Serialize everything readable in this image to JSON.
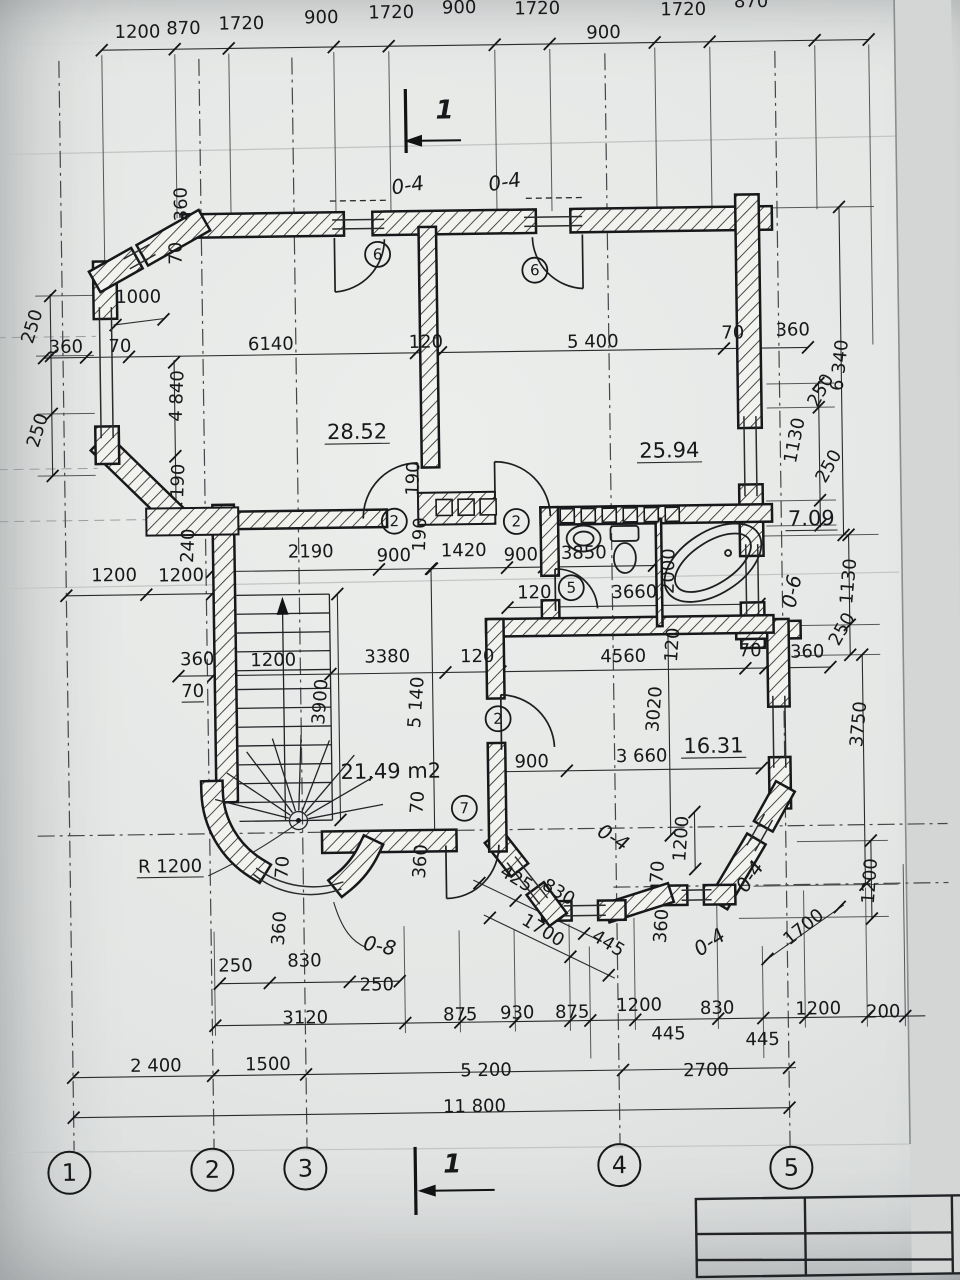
{
  "sheet": {
    "type": "architectural-floor-plan",
    "scan_style": "photographed blueprint"
  },
  "colors": {
    "ink": "#1a1b1d",
    "paper": "#e9eae7",
    "shadow": "#c0c3c5"
  },
  "annotations": {
    "section_label": "1",
    "dims": [
      {
        "t": "1200",
        "x": 146,
        "y": 33
      },
      {
        "t": "870",
        "x": 192,
        "y": 30
      },
      {
        "t": "1720",
        "x": 250,
        "y": 26
      },
      {
        "t": "900",
        "x": 330,
        "y": 21
      },
      {
        "t": "1720",
        "x": 400,
        "y": 17
      },
      {
        "t": "900",
        "x": 468,
        "y": 13
      },
      {
        "t": "1720",
        "x": 546,
        "y": 15
      },
      {
        "t": "900",
        "x": 612,
        "y": 40
      },
      {
        "t": "1720",
        "x": 692,
        "y": 18
      },
      {
        "t": "870",
        "x": 760,
        "y": 11
      },
      {
        "t": "360",
        "x": 193,
        "y": 200,
        "r": -90
      },
      {
        "t": "70",
        "x": 187,
        "y": 249,
        "r": -90
      },
      {
        "t": "1000",
        "x": 143,
        "y": 298
      },
      {
        "t": "250",
        "x": 42,
        "y": 322,
        "r": -72
      },
      {
        "t": "250",
        "x": 46,
        "y": 426,
        "r": -72
      },
      {
        "t": "360",
        "x": 70,
        "y": 347
      },
      {
        "t": "70",
        "x": 124,
        "y": 347
      },
      {
        "t": "6140",
        "x": 275,
        "y": 347
      },
      {
        "t": "120",
        "x": 430,
        "y": 347
      },
      {
        "t": "5 400",
        "x": 597,
        "y": 349
      },
      {
        "t": "70",
        "x": 737,
        "y": 342
      },
      {
        "t": "360",
        "x": 797,
        "y": 340
      },
      {
        "t": "4 840",
        "x": 186,
        "y": 392,
        "r": -87
      },
      {
        "t": "190",
        "x": 186,
        "y": 477,
        "r": -87
      },
      {
        "t": "6 340",
        "x": 849,
        "y": 371,
        "r": -83
      },
      {
        "t": "250",
        "x": 829,
        "y": 398,
        "r": -60
      },
      {
        "t": "1130",
        "x": 803,
        "y": 446,
        "r": -78
      },
      {
        "t": "250",
        "x": 836,
        "y": 474,
        "r": -60
      },
      {
        "t": "240",
        "x": 195,
        "y": 542,
        "r": -87
      },
      {
        "t": "2190",
        "x": 312,
        "y": 555
      },
      {
        "t": "900",
        "x": 395,
        "y": 560
      },
      {
        "t": "1420",
        "x": 465,
        "y": 556
      },
      {
        "t": "900",
        "x": 522,
        "y": 561
      },
      {
        "t": "3850",
        "x": 585,
        "y": 560
      },
      {
        "t": "190",
        "x": 421,
        "y": 478,
        "r": -87
      },
      {
        "t": "190",
        "x": 427,
        "y": 534,
        "r": -87
      },
      {
        "t": "1200",
        "x": 115,
        "y": 576
      },
      {
        "t": "1200",
        "x": 182,
        "y": 577
      },
      {
        "t": "120",
        "x": 535,
        "y": 599
      },
      {
        "t": "3660",
        "x": 635,
        "y": 600
      },
      {
        "t": "2000",
        "x": 675,
        "y": 574,
        "r": -88
      },
      {
        "t": "1130",
        "x": 855,
        "y": 587,
        "r": -84
      },
      {
        "t": "250",
        "x": 847,
        "y": 637,
        "r": -60
      },
      {
        "t": "360",
        "x": 807,
        "y": 662
      },
      {
        "t": "360",
        "x": 197,
        "y": 661
      },
      {
        "t": "1200",
        "x": 273,
        "y": 663
      },
      {
        "t": "70",
        "x": 192,
        "y": 693,
        "u": 1
      },
      {
        "t": "3900",
        "x": 325,
        "y": 700,
        "r": -85
      },
      {
        "t": "3380",
        "x": 387,
        "y": 661
      },
      {
        "t": "120",
        "x": 477,
        "y": 662
      },
      {
        "t": "4560",
        "x": 623,
        "y": 664
      },
      {
        "t": "120",
        "x": 678,
        "y": 648,
        "r": -85
      },
      {
        "t": "70",
        "x": 750,
        "y": 660
      },
      {
        "t": "5 140",
        "x": 421,
        "y": 702,
        "r": -85
      },
      {
        "t": "3020",
        "x": 659,
        "y": 712,
        "r": -85
      },
      {
        "t": "3750",
        "x": 863,
        "y": 730,
        "r": -84
      },
      {
        "t": "900",
        "x": 530,
        "y": 768
      },
      {
        "t": "3 660",
        "x": 640,
        "y": 764
      },
      {
        "t": "70",
        "x": 285,
        "y": 865,
        "r": -85
      },
      {
        "t": "360",
        "x": 281,
        "y": 926,
        "r": -85
      },
      {
        "t": "70",
        "x": 421,
        "y": 802,
        "r": -85
      },
      {
        "t": "360",
        "x": 423,
        "y": 861,
        "r": -85
      },
      {
        "t": "425",
        "x": 510,
        "y": 884,
        "r": 32
      },
      {
        "t": "830",
        "x": 552,
        "y": 898,
        "r": 32
      },
      {
        "t": "1700",
        "x": 536,
        "y": 936,
        "r": 32
      },
      {
        "t": "445",
        "x": 601,
        "y": 950,
        "r": 32
      },
      {
        "t": "70",
        "x": 660,
        "y": 875,
        "r": -85
      },
      {
        "t": "1200",
        "x": 684,
        "y": 842,
        "r": -85
      },
      {
        "t": "360",
        "x": 663,
        "y": 929,
        "r": -85
      },
      {
        "t": "1700",
        "x": 803,
        "y": 936,
        "r": -38
      },
      {
        "t": "1200",
        "x": 872,
        "y": 887,
        "r": -85
      },
      {
        "t": "250",
        "x": 231,
        "y": 968
      },
      {
        "t": "830",
        "x": 300,
        "y": 964
      },
      {
        "t": "250",
        "x": 372,
        "y": 989
      },
      {
        "t": "R 1200",
        "x": 167,
        "y": 868,
        "u": 1
      },
      {
        "t": "3120",
        "x": 300,
        "y": 1021
      },
      {
        "t": "875",
        "x": 455,
        "y": 1020
      },
      {
        "t": "930",
        "x": 512,
        "y": 1019
      },
      {
        "t": "875",
        "x": 567,
        "y": 1019
      },
      {
        "t": "1200",
        "x": 634,
        "y": 1013
      },
      {
        "t": "445",
        "x": 663,
        "y": 1042
      },
      {
        "t": "830",
        "x": 712,
        "y": 1017
      },
      {
        "t": "445",
        "x": 757,
        "y": 1049
      },
      {
        "t": "1200",
        "x": 813,
        "y": 1019
      },
      {
        "t": "200",
        "x": 878,
        "y": 1023
      },
      {
        "t": "2 400",
        "x": 150,
        "y": 1067
      },
      {
        "t": "1500",
        "x": 262,
        "y": 1067
      },
      {
        "t": "5 200",
        "x": 480,
        "y": 1076
      },
      {
        "t": "2700",
        "x": 700,
        "y": 1079
      },
      {
        "t": "11 800",
        "x": 468,
        "y": 1112
      }
    ],
    "rooms": [
      {
        "t": "28.52",
        "x": 360,
        "y": 437,
        "u": 1
      },
      {
        "t": "25.94",
        "x": 672,
        "y": 460,
        "u": 1
      },
      {
        "t": "7.09",
        "x": 813,
        "y": 530,
        "u": 1
      },
      {
        "t": "16.31",
        "x": 712,
        "y": 756,
        "u": 1
      },
      {
        "t": "21,49 m2",
        "x": 389,
        "y": 777
      }
    ],
    "door_marks": [
      {
        "t": "6",
        "x": 383,
        "y": 253
      },
      {
        "t": "6",
        "x": 540,
        "y": 271
      },
      {
        "t": "2",
        "x": 396,
        "y": 520
      },
      {
        "t": "2",
        "x": 518,
        "y": 522
      },
      {
        "t": "5",
        "x": 572,
        "y": 589
      },
      {
        "t": "2",
        "x": 497,
        "y": 719
      },
      {
        "t": "7",
        "x": 462,
        "y": 808
      }
    ],
    "opening_marks": [
      {
        "t": "0-4",
        "x": 415,
        "y": 191,
        "r": -8
      },
      {
        "t": "0-4",
        "x": 512,
        "y": 189,
        "r": -8
      },
      {
        "t": "0-6",
        "x": 799,
        "y": 597,
        "r": -78
      },
      {
        "t": "0-4",
        "x": 607,
        "y": 845,
        "r": 32
      },
      {
        "t": "0-4",
        "x": 752,
        "y": 884,
        "r": -55
      },
      {
        "t": "0-4",
        "x": 709,
        "y": 951,
        "r": -33
      },
      {
        "t": "0-8",
        "x": 374,
        "y": 951,
        "r": 12
      }
    ],
    "axis_bubbles": [
      {
        "t": "1",
        "x": 62,
        "y": 1167
      },
      {
        "t": "2",
        "x": 205,
        "y": 1166
      },
      {
        "t": "3",
        "x": 298,
        "y": 1166
      },
      {
        "t": "4",
        "x": 612,
        "y": 1167
      },
      {
        "t": "5",
        "x": 784,
        "y": 1172
      }
    ]
  }
}
